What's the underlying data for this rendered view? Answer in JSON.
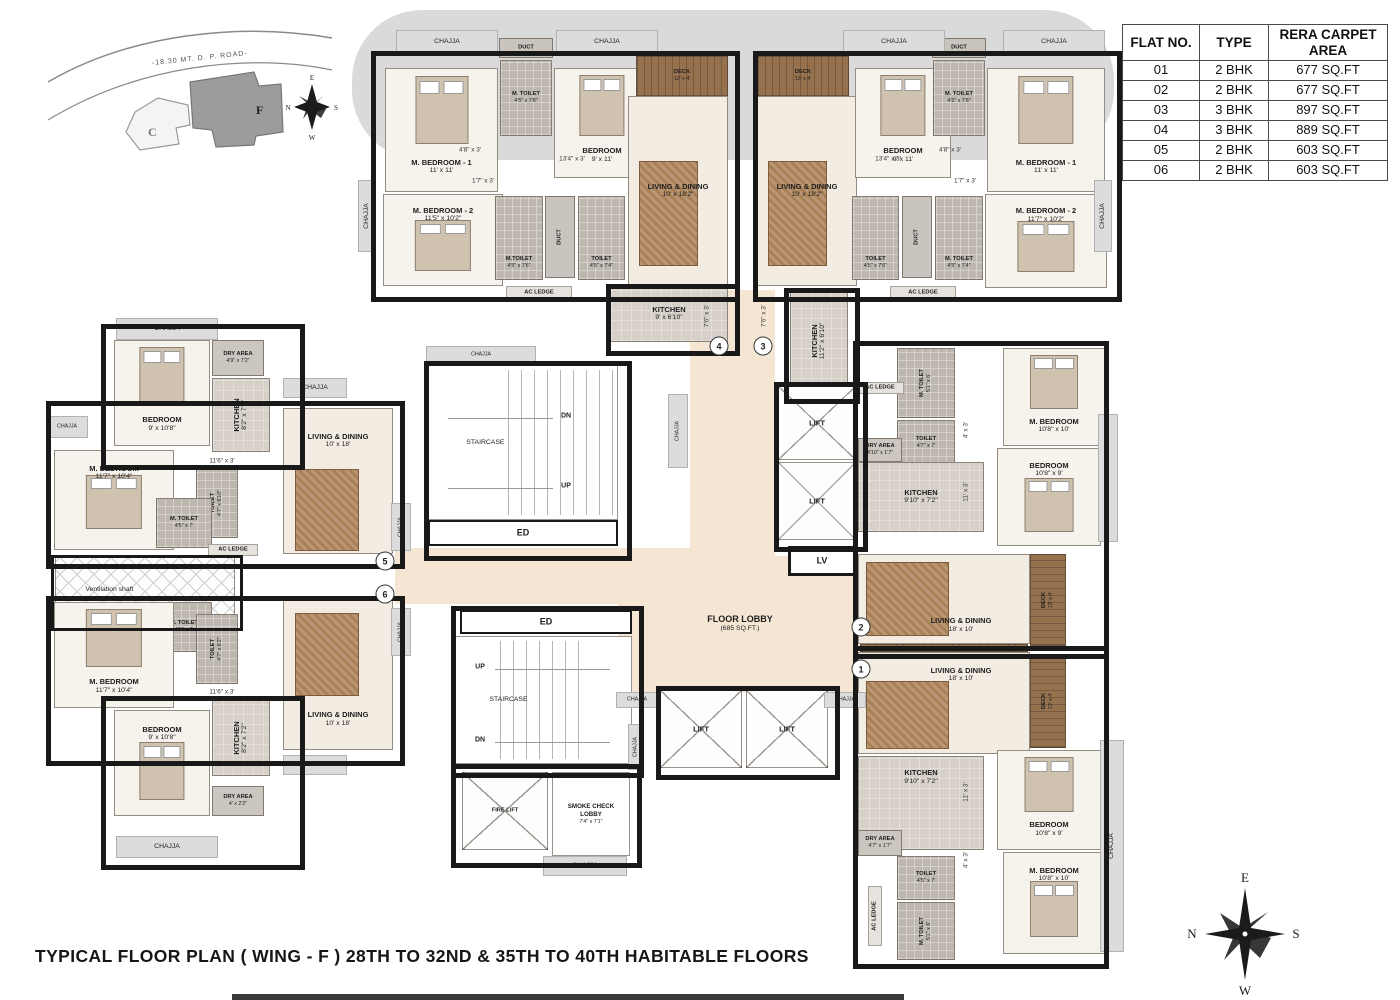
{
  "title": "TYPICAL  FLOOR PLAN ( WING - F ) 28TH TO 32ND & 35TH TO 40TH  HABITABLE FLOORS",
  "key_plan": {
    "road_label": "-18.30 MT. D. P. ROAD-",
    "wing_c_label": "C",
    "wing_f_label": "F"
  },
  "compass": {
    "top": "E",
    "right": "S",
    "bottom": "W",
    "left": "N"
  },
  "flat_table": {
    "headers": [
      "FLAT NO.",
      "TYPE",
      "RERA CARPET AREA"
    ],
    "rows": [
      [
        "01",
        "2 BHK",
        "677 SQ.FT"
      ],
      [
        "02",
        "2 BHK",
        "677 SQ.FT"
      ],
      [
        "03",
        "3 BHK",
        "897 SQ.FT"
      ],
      [
        "04",
        "3 BHK",
        "889 SQ.FT"
      ],
      [
        "05",
        "2 BHK",
        "603 SQ.FT"
      ],
      [
        "06",
        "2 BHK",
        "603 SQ.FT"
      ]
    ]
  },
  "circles": {
    "c1": "1",
    "c2": "2",
    "c3": "3",
    "c4": "4",
    "c5": "5",
    "c6": "6"
  },
  "labels": {
    "f4_mbed1": {
      "n": "M. BEDROOM - 1",
      "d": "11' x 11'"
    },
    "f4_bed": {
      "n": "BEDROOM",
      "d": "9' x 11'"
    },
    "f4_mtoil_a": {
      "n": "M. TOILET",
      "d": "4'5\" x 7'8\""
    },
    "f4_mbed2": {
      "n": "M. BEDROOM - 2",
      "d": "11'5\" x 10'2\""
    },
    "f4_mtoil_b": {
      "n": "M.TOILET",
      "d": "4'5\" x 7'6\""
    },
    "f4_toil": {
      "n": "TOILET",
      "d": "4'5\" x 7'4\""
    },
    "f4_kit": {
      "n": "KITCHEN",
      "d": "9' x 6'10\""
    },
    "f4_liv": {
      "n": "LIVING & DINING",
      "d": "10' x 18'2\""
    },
    "f4_deck": {
      "n": "DECK",
      "d": "12' x 4'"
    },
    "f3_deck": {
      "n": "DECK",
      "d": "13' x 4'"
    },
    "f3_liv": {
      "n": "LIVING & DINING",
      "d": "10' x 18'2\""
    },
    "f3_bed": {
      "n": "BEDROOM",
      "d": "9' x 11'"
    },
    "f3_mtoil_a": {
      "n": "M. TOILET",
      "d": "4'5\" x 7'8\""
    },
    "f3_mbed1": {
      "n": "M. BEDROOM - 1",
      "d": "11' x 11'"
    },
    "f3_mbed2": {
      "n": "M. BEDROOM - 2",
      "d": "11'7\" x 10'2\""
    },
    "f3_toil": {
      "n": "TOILET",
      "d": "4'5\" x 7'6\""
    },
    "f3_mtoil_b": {
      "n": "M. TOILET",
      "d": "4'5\" x 7'4\""
    },
    "f3_kit": {
      "n": "KITCHEN",
      "d": "11'2\" x 6'10\""
    },
    "f5_bed": {
      "n": "BEDROOM",
      "d": "9' x 10'8\""
    },
    "f5_dry": {
      "n": "DRY AREA",
      "d": "4'9\" x 7'2\""
    },
    "f5_kit": {
      "n": "KITCHEN",
      "d": "8'2\" x 7'2\""
    },
    "f5_mbed": {
      "n": "M. BEDROOM",
      "d": "11'7\" x 10'4\""
    },
    "f5_toil": {
      "n": "TOILET",
      "d": "4'7\" x 6'10\""
    },
    "f5_mtoil": {
      "n": "M. TOILET",
      "d": "4'5\" x 7'"
    },
    "f5_liv": {
      "n": "LIVING & DINING",
      "d": "10' x 18'"
    },
    "f6_mtoil": {
      "n": "M. TOILET",
      "d": "4'5\" x 7'"
    },
    "f6_toil": {
      "n": "TOILET",
      "d": "4'7\" x 6'2\""
    },
    "f6_mbed": {
      "n": "M. BEDROOM",
      "d": "11'7\" x 10'4\""
    },
    "f6_liv": {
      "n": "LIVING & DINING",
      "d": "10' x 18'"
    },
    "f6_bed": {
      "n": "BEDROOM",
      "d": "9' x 10'8\""
    },
    "f6_kit": {
      "n": "KITCHEN",
      "d": "8'2\" x 7'2\""
    },
    "f6_dry": {
      "n": "DRY AREA",
      "d": "4' x 2'2\""
    },
    "f2_mtoil": {
      "n": "M. TOILET",
      "d": "5'1\" x 6'"
    },
    "f2_toil": {
      "n": "TOILET",
      "d": "4'7\" x 7'"
    },
    "f2_dry": {
      "n": "DRY AREA",
      "d": "4'10\" x 1'7\""
    },
    "f2_kit": {
      "n": "KITCHEN",
      "d": "9'10\" x 7'2\""
    },
    "f2_mbed": {
      "n": "M. BEDROOM",
      "d": "10'8\" x 10'"
    },
    "f2_bed": {
      "n": "BEDROOM",
      "d": "10'8\" x 9'"
    },
    "f2_liv": {
      "n": "LIVING & DINING",
      "d": "18' x 10'"
    },
    "f2_deck": {
      "n": "DECK",
      "d": "13' x 4'"
    },
    "f1_liv": {
      "n": "LIVING & DINING",
      "d": "18' x 10'"
    },
    "f1_deck": {
      "n": "DECK",
      "d": "13' x 4'"
    },
    "f1_kit": {
      "n": "KITCHEN",
      "d": "9'10\" x 7'2\""
    },
    "f1_dry": {
      "n": "DRY AREA",
      "d": "4'7\" x 1'7\""
    },
    "f1_toil": {
      "n": "TOILET",
      "d": "4'5\" x 7'"
    },
    "f1_mtoil": {
      "n": "M. TOILET",
      "d": "5'1\" x 6'"
    },
    "f1_bed": {
      "n": "BEDROOM",
      "d": "10'8\" x 9'"
    },
    "f1_mbed": {
      "n": "M. BEDROOM",
      "d": "10'8\" x 10'"
    },
    "smoke": {
      "n": "SMOKE CHECK LOBBY",
      "d": "7'4\" x 7'1\""
    },
    "lobby": {
      "n": "FLOOR LOBBY",
      "d": "(685 SQ.FT.)"
    },
    "stair": "STAIRCASE",
    "ed": "ED",
    "dn": "DN",
    "up": "UP",
    "lift": "LIFT",
    "fire": "FIRE LIFT",
    "lv": "LV",
    "vent": "Ventilation shaft",
    "chajja": "CHAJJA",
    "duct": "DUCT",
    "ac": "AC LEDGE",
    "p48": "4'8\" x 3'",
    "p134": "13'4\" x 3'",
    "p17": "1'7\" x 3'",
    "p76": "7'6\" x 3'",
    "p116": "11'6\" x 3'",
    "p11": "11' x 3'",
    "p4": "4' x 3'"
  }
}
